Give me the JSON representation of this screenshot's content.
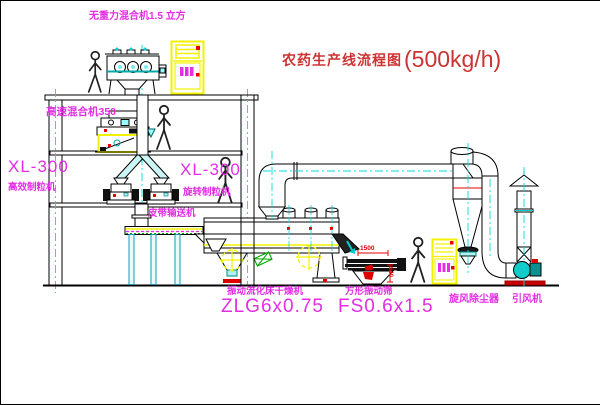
{
  "diagram": {
    "title": {
      "name_cn": "农药生产线流程图",
      "capacity": "(500kg/h)"
    },
    "annotations": {
      "top_mixer": "无重力混合机1.5 立方",
      "high_speed_mixer": "高速混合机350",
      "left_granulator_model": "XL-300",
      "left_granulator_name": "高效制粒机",
      "right_granulator_model": "XL-300",
      "right_granulator_name": "旋转制粒机",
      "belt_conveyor": "皮带输送机",
      "dryer_name": "振动流化床干燥机",
      "dryer_model": "ZLG6x0.75",
      "sieve_name": "方形振动筛",
      "sieve_model": "FS0.6x1.5",
      "cyclone_name": "旋风除尘器",
      "fan_name": "引风机",
      "dim_length": "1500",
      "dim_height": "540"
    },
    "colors": {
      "annotation_magenta": "#e32ee3",
      "title_red": "#cc3333",
      "dimension_red": "#e00000",
      "cabinet_yellow": "#f2f200",
      "centerline_cyan": "#00dcdc",
      "valve_cyan": "#aef2f2",
      "status_red": "#dd0000",
      "guard_green": "#00a000"
    }
  }
}
